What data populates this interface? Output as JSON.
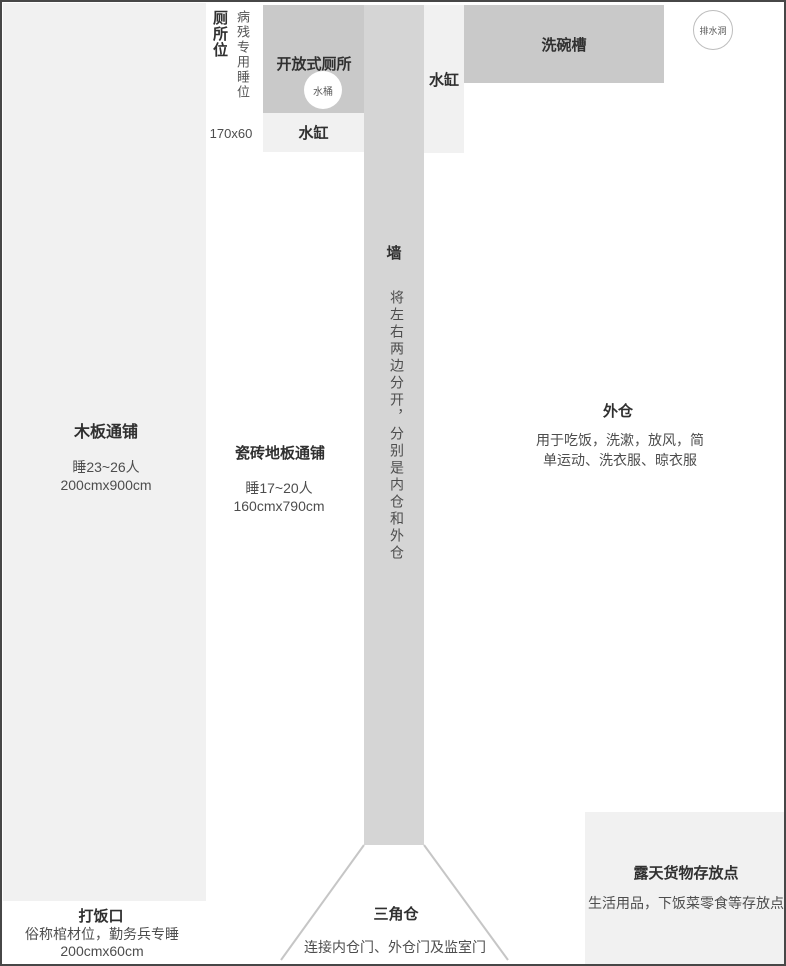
{
  "palette": {
    "block_dark": "#c9c9c9",
    "wall_gray": "#d5d5d5",
    "block_light": "#f1f1f1",
    "outline": "#474747",
    "triangle_line": "#c6c6c6",
    "text_primary": "#303030",
    "text_secondary": "#4d4d4d"
  },
  "regions": {
    "wood_bed": {
      "title": "木板通铺",
      "line1": "睡23~26人",
      "line2": "200cmx900cm"
    },
    "toilet_spot": {
      "title": "厕所位",
      "subtitle": "病残专用睡位",
      "size": "170x60"
    },
    "open_toilet": {
      "title": "开放式厕所",
      "bucket_label": "水桶"
    },
    "vat_below_toilet": {
      "title": "水缸"
    },
    "vat_right_of_wall": {
      "title": "水缸"
    },
    "sink": {
      "title": "洗碗槽"
    },
    "drain": {
      "title": "排水洞"
    },
    "wall": {
      "title": "墙",
      "desc": "将左右两边分开，分别是内仓和外仓"
    },
    "tile_bed": {
      "title": "瓷砖地板通铺",
      "line1": "睡17~20人",
      "line2": "160cmx790cm"
    },
    "outer_cabin": {
      "title": "外仓",
      "desc": "用于吃饭，洗漱，放风，简单运动、洗衣服、晾衣服"
    },
    "food_port": {
      "title": "打饭口",
      "line1": "俗称棺材位，勤务兵专睡",
      "line2": "200cmx60cm"
    },
    "triangle_cabin": {
      "title": "三角仓",
      "desc": "连接内仓门、外仓门及监室门"
    },
    "storage": {
      "title": "露天货物存放点",
      "desc": "生活用品，下饭菜零食等存放点"
    }
  }
}
